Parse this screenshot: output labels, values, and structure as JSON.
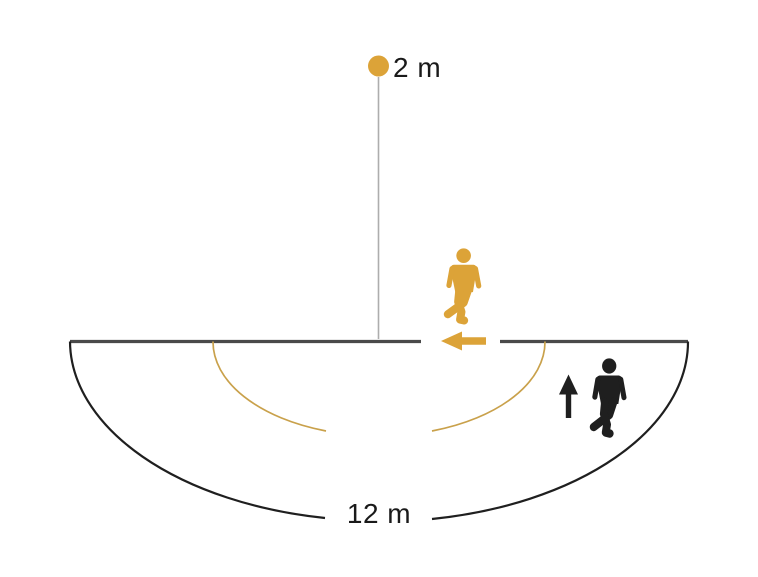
{
  "diagram": {
    "labels": {
      "mounting_height": "2 m",
      "detection_range": "12 m"
    },
    "colors": {
      "accent_orange": "#DCA338",
      "arc_orange": "#C9A14B",
      "line_dark": "#4A4A4A",
      "arc_black": "#1F1F1F",
      "guide_gray": "#ADADAD",
      "text": "#1A1A1A",
      "background": "#FFFFFF"
    },
    "icons": {
      "sensor": "sensor-dot-icon",
      "tangential_walker": "walking-person-orange-icon",
      "radial_walker": "walking-person-black-icon",
      "tangential_direction": "arrow-left-icon",
      "radial_direction": "arrow-up-icon"
    }
  }
}
